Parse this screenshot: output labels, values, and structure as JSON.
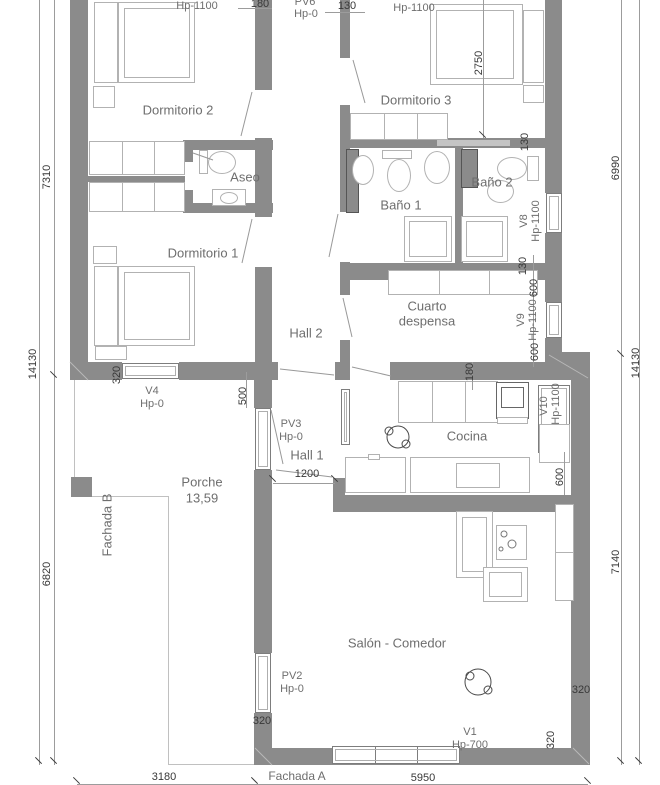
{
  "plan": {
    "rooms": {
      "dormitorio2": "Dormitorio 2",
      "dormitorio1": "Dormitorio 1",
      "dormitorio3": "Dormitorio 3",
      "aseo": "Aseo",
      "bano1": "Baño 1",
      "bano2": "Baño 2",
      "cuarto_line1": "Cuarto",
      "cuarto_line2": "despensa",
      "cocina": "Cocina",
      "hall1": "Hall 1",
      "hall2": "Hall 2",
      "porche": "Porche",
      "porche_area": "13,59",
      "salon": "Salón - Comedor"
    },
    "facades": {
      "a": "Fachada A",
      "b": "Fachada B"
    },
    "openings": {
      "v4": "V4",
      "v4_hp": "Hp-0",
      "pv2": "PV2",
      "pv2_hp": "Hp-0",
      "pv3": "PV3",
      "pv3_hp": "Hp-0",
      "pv6": "PV6",
      "pv6_hp": "Hp-0",
      "v1": "V1",
      "v1_hp": "Hp-700",
      "v8": "V8",
      "v8_hp": "Hp-1100",
      "v9": "V9",
      "v9_hp": "Hp-1100",
      "v10": "V10",
      "v10_hp": "Hp-1100",
      "dorm2_top_hp": "Hp-1100",
      "dorm3_top_hp": "Hp-1100"
    },
    "dims": {
      "left_top": "7310",
      "left_full": "14130",
      "left_bottom": "6820",
      "right_top": "6990",
      "right_full": "14130",
      "right_bottom": "7140",
      "bottom_porch": "3180",
      "bottom_salon": "5950",
      "dorm3_depth": "2750",
      "top_wall_a": "180",
      "top_wall_b": "130",
      "bath_wall": "130",
      "despensa_wall": "130",
      "v9_top": "600",
      "v9_bottom": "600",
      "v10_offset": "600",
      "kitchen_wall": "180",
      "porch_offset": "500",
      "hall_door": "1200",
      "v4_w": "320",
      "pv2_w": "320",
      "salon_wall": "320",
      "salon_bottom": "320"
    },
    "colors": {
      "wall": "#8b8b8b",
      "furniture_line": "#b2b2b2",
      "dim_text": "#383838",
      "label_text": "#6e6e6e"
    }
  }
}
